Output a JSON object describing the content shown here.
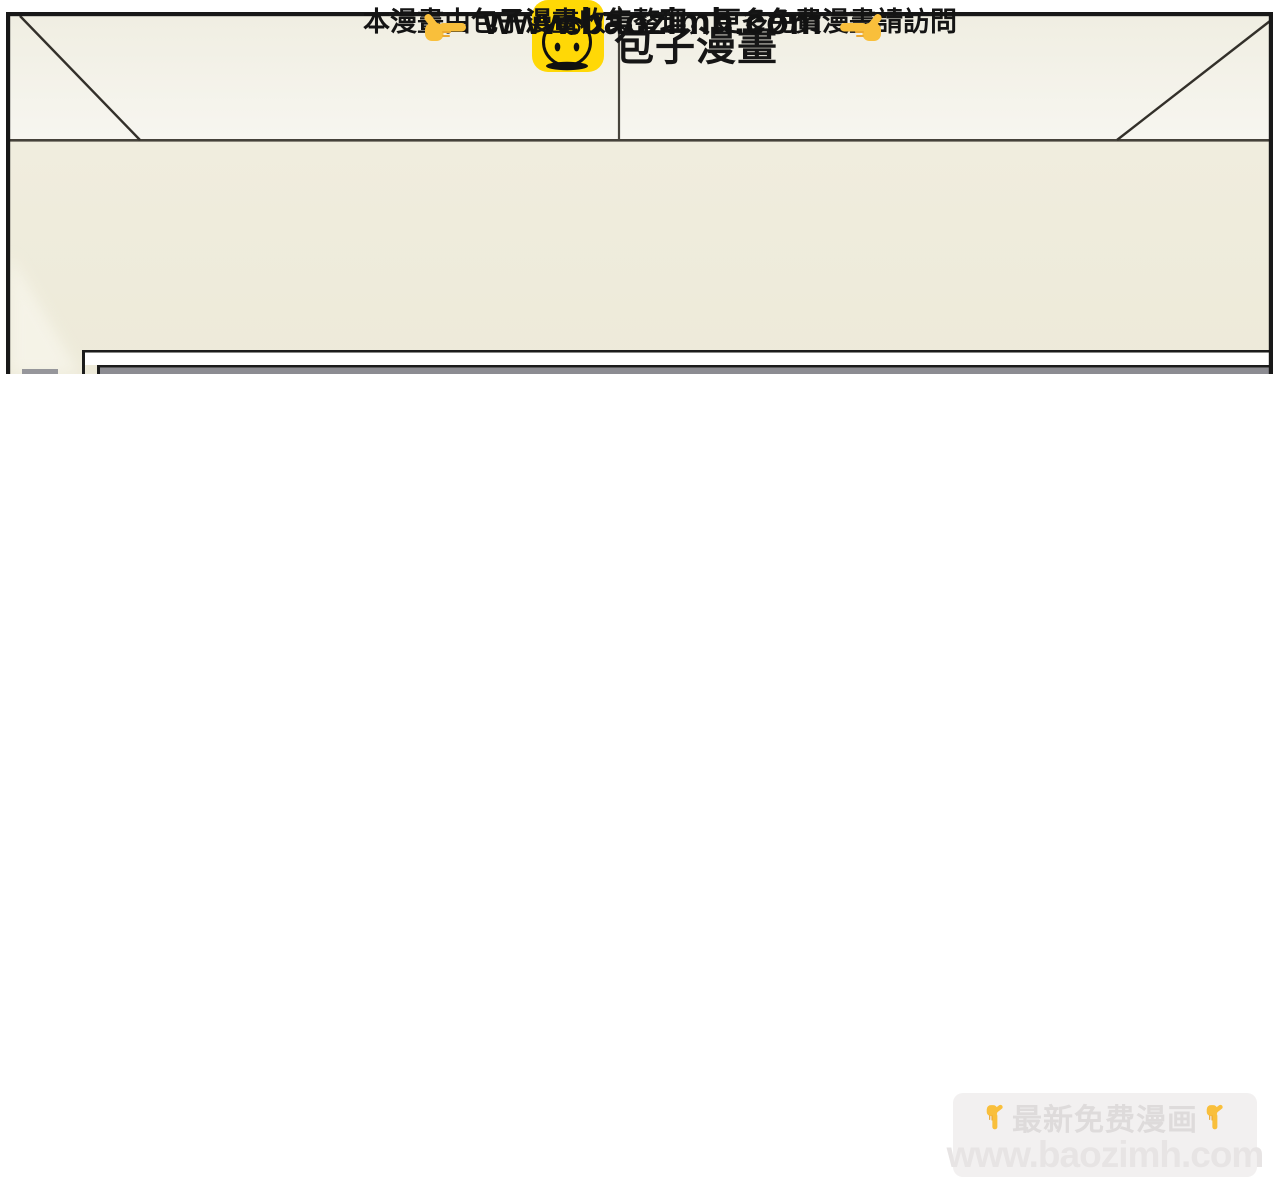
{
  "comic_panel": {
    "description_of_scene": "empty room interior: ceiling band with perspective lines above a cream wall, top of a grey-and-white board cut off at bottom",
    "colors": {
      "ceiling_top": "#f0eee2",
      "ceiling_bottom": "#f7f6f0",
      "wall": "#efecdc",
      "line_dark": "#35322b",
      "panel_border": "#181818",
      "board_grey": "#8c8c92"
    }
  },
  "footer": {
    "brand": {
      "logo_icon": "baozi-bun-icon",
      "logo_color": "#ffd806",
      "title": "包子漫畫"
    },
    "notice": "本漫畫由包子漫畫收集整理，更多免費漫畫請訪問",
    "url": "www.baozimh.com",
    "left_hand_icon": "pointing-right-hand",
    "right_hand_icon": "pointing-left-hand",
    "hand_color": "#f9bf3b"
  },
  "watermark": {
    "line1": "最新免费漫画",
    "line2": "www.baozimh.com",
    "hand_icon": "pointing-down-hand",
    "box_color": "#f2f0f0",
    "text_color": "#dedbdb"
  }
}
